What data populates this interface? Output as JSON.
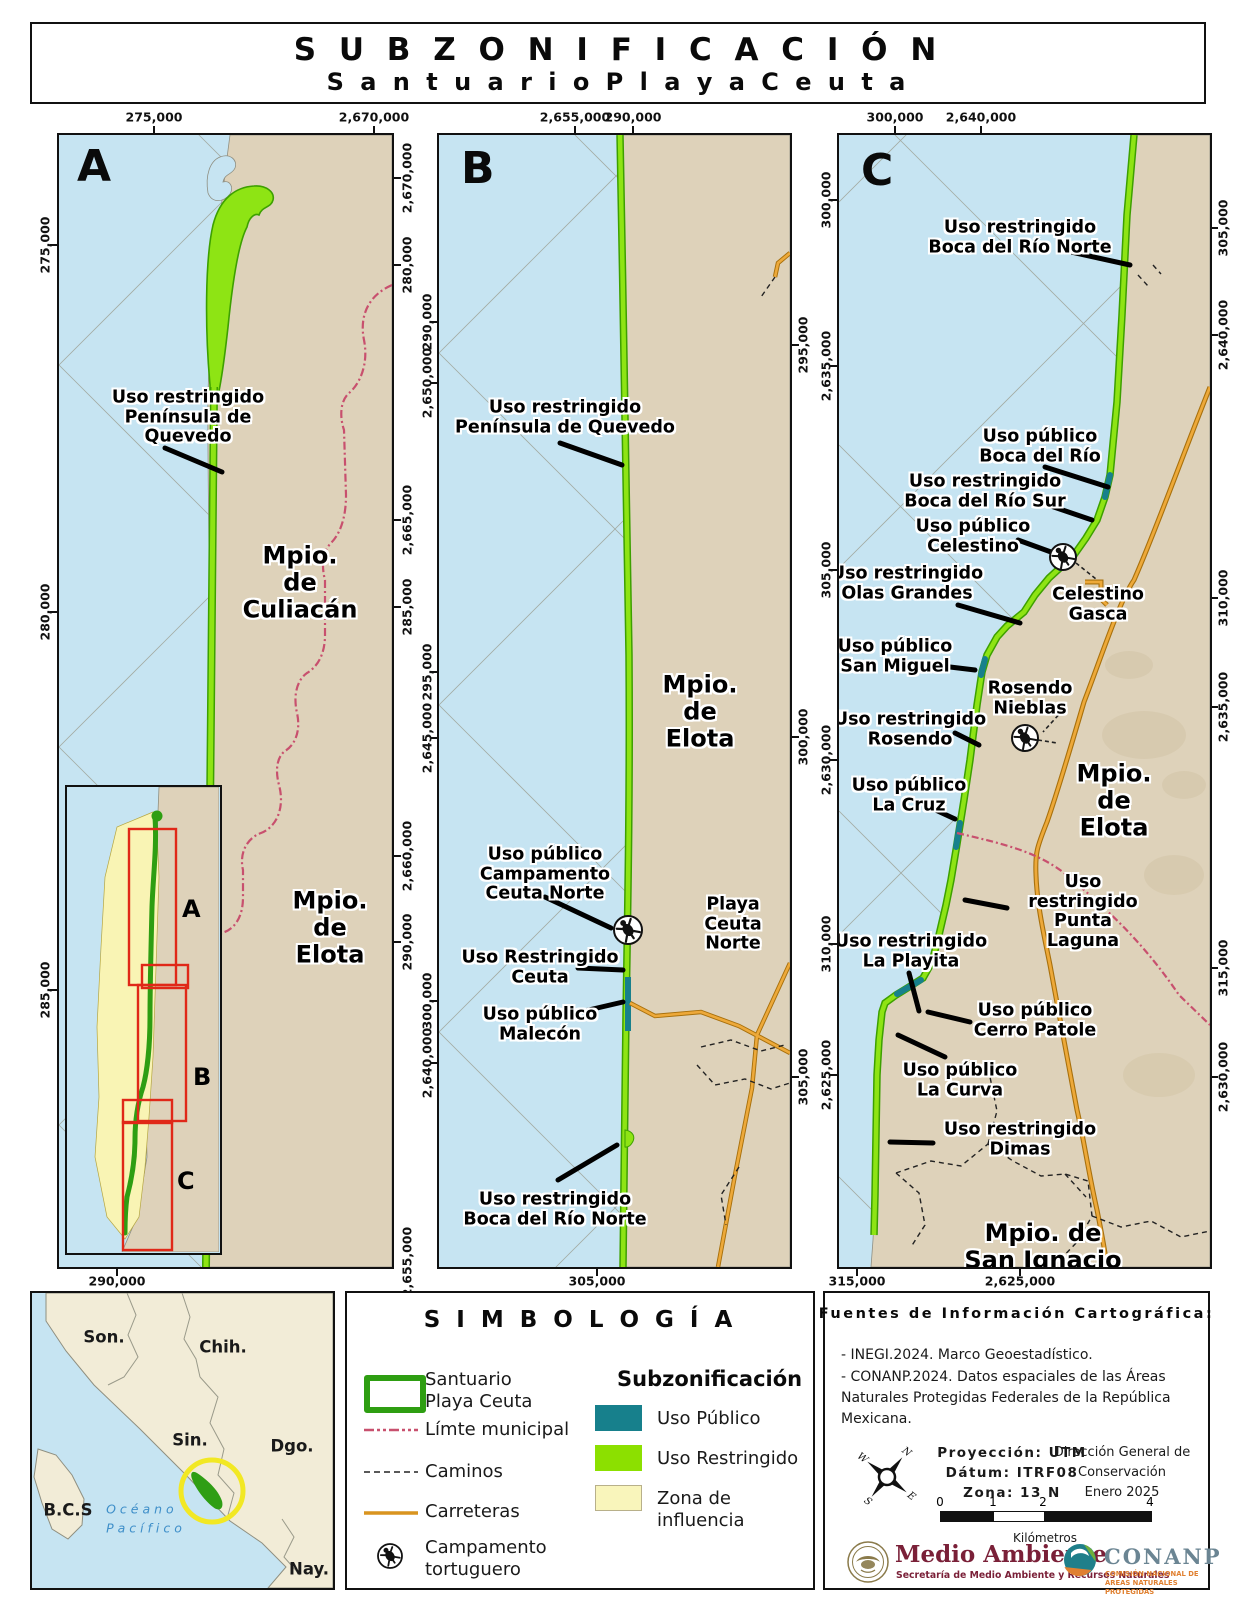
{
  "colors": {
    "ocean": "#c6e4f2",
    "land": "#ded2ba",
    "zona_influencia": "#f9f4b4",
    "uso_restringido": "#8ee414",
    "uso_publico": "#17808c",
    "carretera": "#eda93a",
    "limite_municipal": "#c8506e",
    "santuario_outline": "#2e9e12"
  },
  "title": {
    "line1": "S U B Z O N I F I C A C I Ó N",
    "line2": "S a n t u a r i o   P l a y a   C e u t a"
  },
  "panelA": {
    "letter": "A",
    "ticks": {
      "top": [
        "275,000",
        "2,670,000"
      ],
      "bottom": [
        "290,000"
      ],
      "left": [
        "275,000",
        "280,000",
        "285,000"
      ],
      "right": [
        "2,670,000",
        "280,000",
        "2,665,000",
        "285,000",
        "2,660,000",
        "290,000",
        "2,655,000"
      ]
    },
    "labels": {
      "quevedo": "Uso restringido\nPenínsula de Quevedo",
      "culiacan": "Mpio. de\nCuliacán",
      "elota": "Mpio. de\nElota"
    },
    "inset": {
      "a": "A",
      "b": "B",
      "c": "C"
    }
  },
  "panelB": {
    "letter": "B",
    "ticks": {
      "top": [
        "2,655,000",
        "290,000"
      ],
      "bottom": [
        "305,000"
      ],
      "left": [
        "290,000",
        "2,650,000",
        "295,000",
        "2,645,000",
        "300,000",
        "2,640,000"
      ],
      "right": [
        "295,000",
        "300,000",
        "305,000"
      ]
    },
    "labels": {
      "quevedo": "Uso restringido\nPenínsula de Quevedo",
      "elota": "Mpio. de\nElota",
      "campamento": "Uso público\nCampamento\nCeuta Norte",
      "playa": "Playa Ceuta\nNorte",
      "ceuta": "Uso Restringido\nCeuta",
      "malecon": "Uso público\nMalecón",
      "boca_norte": "Uso restringido\nBoca del Río Norte"
    }
  },
  "panelC": {
    "letter": "C",
    "ticks": {
      "top": [
        "300,000",
        "2,640,000"
      ],
      "bottom": [
        "315,000",
        "2,625,000"
      ],
      "left": [
        "300,000",
        "2,635,000",
        "305,000",
        "2,630,000",
        "310,000",
        "2,625,000"
      ],
      "right": [
        "305,000",
        "2,640,000",
        "310,000",
        "2,635,000",
        "315,000",
        "2,630,000"
      ]
    },
    "labels": {
      "boca_norte": "Uso restringido\nBoca del Río Norte",
      "boca": "Uso público\nBoca del Río",
      "boca_sur": "Uso restringido\nBoca del Río Sur",
      "celestino": "Uso público\nCelestino",
      "celestino_gasca": "Celestino\nGasca",
      "olas": "Uso restringido\nOlas Grandes",
      "san_miguel": "Uso público\nSan Miguel",
      "rosendo_nieblas": "Rosendo\nNieblas",
      "rosendo": "Uso restringido\nRosendo",
      "la_cruz": "Uso público\nLa Cruz",
      "elota": "Mpio. de\nElota",
      "punta_laguna": "Uso restringido\nPunta Laguna",
      "la_playita": "Uso restringido\nLa Playita",
      "cerro_patole": "Uso público\nCerro Patole",
      "la_curva": "Uso público\nLa Curva",
      "dimas": "Uso restringido\nDimas",
      "san_ignacio": "Mpio. de\nSan Ignacio"
    }
  },
  "locator": {
    "states": {
      "son": "Son.",
      "chih": "Chih.",
      "sin": "Sin.",
      "dgo": "Dgo.",
      "bcs": "B.C.S",
      "nay": "Nay."
    },
    "ocean": "O c é a n o\nP a c í f i c o"
  },
  "legend": {
    "title": "S I M B O L O G Í A",
    "items": {
      "santuario": "Santuario\nPlaya Ceuta",
      "limite": "Límte municipal",
      "caminos": "Caminos",
      "carreteras": "Carreteras",
      "campamento": "Campamento\ntortuguero"
    },
    "sub": {
      "title": "Subzonificación",
      "publico": "Uso Público",
      "restringido": "Uso Restringido",
      "zona": "Zona de influencia"
    }
  },
  "info": {
    "title": "Fuentes de Información Cartográfica:",
    "source1": "- INEGI.2024. Marco Geoestadístico.",
    "source2": "- CONANP.2024. Datos espaciales de las Áreas Naturales Protegidas Federales de la República Mexicana.",
    "proj1": "Proyección: UTM",
    "proj2": "Dátum: ITRF08",
    "proj3": "Zona: 13 N",
    "dir1": "Dirección General de",
    "dir2": "Conservación",
    "dir3": "Enero 2025",
    "scale": {
      "t0": "0",
      "t1": "1",
      "t2": "2",
      "t4": "4",
      "unit": "Kilómetros"
    },
    "compass": {
      "n": "N",
      "e": "E",
      "s": "S",
      "w": "W"
    },
    "logos": {
      "ma": "Medio Ambiente",
      "ma_sub": "Secretaría de Medio Ambiente y Recursos Naturales",
      "conanp": "CONANP",
      "conanp_sub": "COMISIÓN NACIONAL DE ÁREAS NATURALES PROTEGIDAS"
    }
  }
}
